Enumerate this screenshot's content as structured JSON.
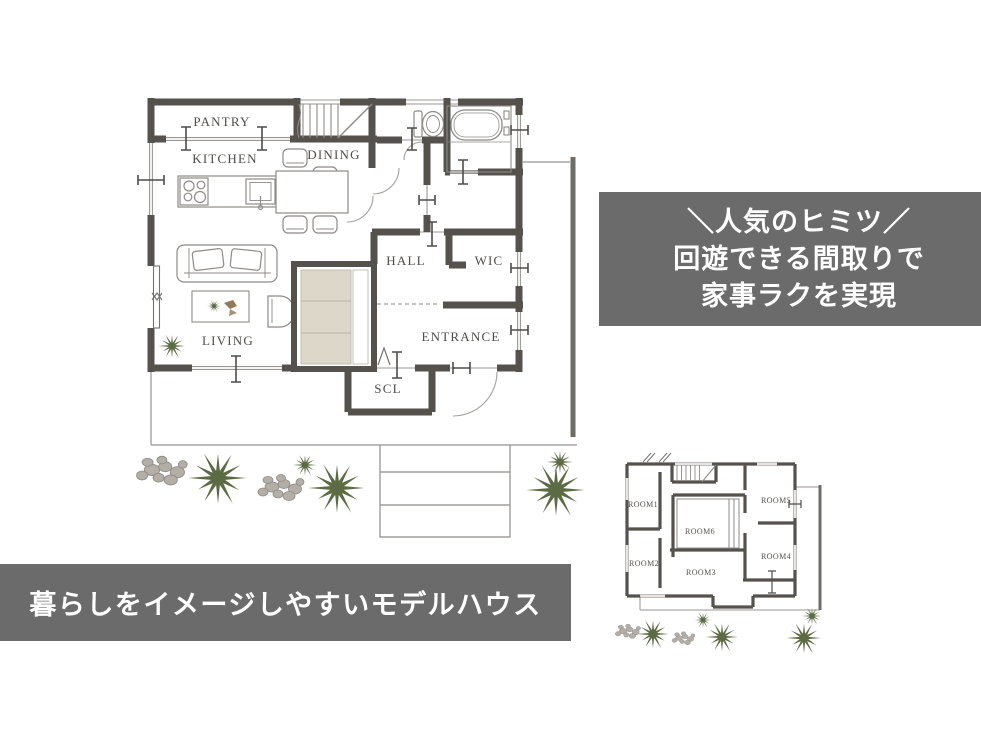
{
  "info_box": {
    "line1": "＼人気のヒミツ／",
    "line2": "回遊できる間取りで",
    "line3": "家事ラクを実現"
  },
  "banner": {
    "text": "暮らしをイメージしやすいモデルハウス"
  },
  "main_plan": {
    "rooms": [
      {
        "id": "pantry",
        "label": "PANTRY"
      },
      {
        "id": "kitchen",
        "label": "KITCHEN"
      },
      {
        "id": "dining",
        "label": "DINING"
      },
      {
        "id": "hall",
        "label": "HALL"
      },
      {
        "id": "wic",
        "label": "WIC"
      },
      {
        "id": "living",
        "label": "LIVING"
      },
      {
        "id": "entrance",
        "label": "ENTRANCE"
      },
      {
        "id": "scl",
        "label": "SCL"
      }
    ]
  },
  "second_plan": {
    "rooms": [
      {
        "id": "room1",
        "label": "ROOM1"
      },
      {
        "id": "room2",
        "label": "ROOM2"
      },
      {
        "id": "room3",
        "label": "ROOM3"
      },
      {
        "id": "room4",
        "label": "ROOM4"
      },
      {
        "id": "room5",
        "label": "ROOM5"
      },
      {
        "id": "room6",
        "label": "ROOM6"
      }
    ]
  },
  "colors": {
    "wall": "#55524e",
    "thin_line": "#979490",
    "label_text": "#4f4d4a",
    "plant_green": "#5d6b45",
    "rock_gray": "#b3afa8",
    "stair_fill": "#dcd7c9",
    "panel_gray": "#6b6b6b",
    "panel_text": "#ffffff"
  }
}
